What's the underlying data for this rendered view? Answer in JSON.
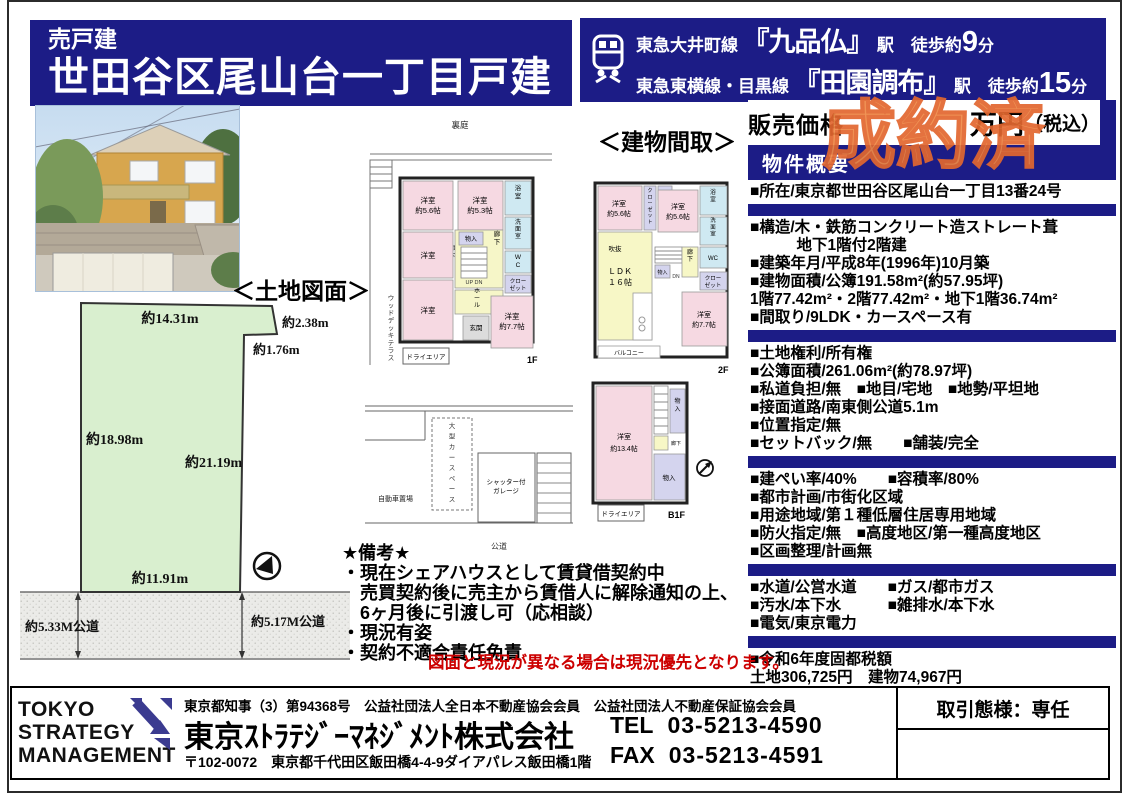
{
  "colors": {
    "navy": "#1c1c86",
    "stamp_orange": "#ef8a47",
    "caption_red": "#cc0000",
    "land_green": "#d9efcf"
  },
  "header": {
    "sale_type": "売戸建",
    "title": "世田谷区尾山台一丁目戸建"
  },
  "access": {
    "lines": [
      {
        "line": "東急大井町線",
        "station": "『九品仏』",
        "mid": "駅　徒歩約",
        "min": "9",
        "unit": "分"
      },
      {
        "line": "東急東横線・目黒線",
        "station": "『田園調布』",
        "mid": "駅　徒歩約",
        "min": "15",
        "unit": "分"
      }
    ]
  },
  "price": {
    "label": "販売価格",
    "stamp": "成約済",
    "unit": "万円",
    "tax": "（税込）"
  },
  "overview": {
    "header": "物件概要",
    "sections": [
      [
        "■所在/東京都世田谷区尾山台一丁目13番24号"
      ],
      [
        "■構造/木・鉄筋コンクリート造ストレート葺",
        "　　　地下1階付2階建",
        "■建築年月/平成8年(1996年)10月築",
        "■建物面積/公簿191.58m²(約57.95坪)",
        " 1階77.42m²・2階77.42m²・地下1階36.74m²",
        "■間取り/9LDK・カースペース有"
      ],
      [
        "■土地権利/所有権",
        "■公簿面積/261.06m²(約78.97坪)",
        "■私道負担/無　■地目/宅地　■地勢/平坦地",
        "■接面道路/南東側公道5.1m",
        "■位置指定/無",
        "■セットバック/無　　■舗装/完全"
      ],
      [
        "■建ぺい率/40%　　■容積率/80%",
        "■都市計画/市街化区域",
        "■用途地域/第１種低層住居専用地域",
        "■防火指定/無　■高度地区/第一種高度地区",
        "■区画整理/計画無"
      ],
      [
        "■水道/公営水道　　■ガス/都市ガス",
        "■汚水/本下水　　　■雑排水/本下水",
        "■電気/東京電力"
      ],
      [
        "■令和6年度固都税額",
        "土地306,725円　建物74,967円"
      ]
    ]
  },
  "land": {
    "title": "＜土地図面＞",
    "m_top": "約14.31m",
    "m_tr": "約2.38m",
    "m_r1": "約1.76m",
    "m_left": "約18.98m",
    "m_right": "約21.19m",
    "m_bottom": "約11.91m",
    "road_left": "約5.33M公道",
    "road_right": "約5.17M公道"
  },
  "plans": {
    "title": "＜建物間取＞",
    "f1": {
      "label": "1F",
      "yard": "裏庭",
      "deck": "ウッドデッキテラス",
      "r56": "洋室",
      "r56s": "約5.6帖",
      "r53": "洋室",
      "r53s": "約5.3帖",
      "bath": "浴室",
      "wash": "洗面室",
      "wc": "WC",
      "mono1": "物入",
      "hall_l": "廊下",
      "hall_r": "廊下",
      "clo_a": "クロー",
      "clo_b": "ゼット",
      "updn": "UP DN",
      "r3": "洋室",
      "r4": "洋室",
      "hall2": "ホール",
      "genkan": "玄関",
      "r77": "洋室",
      "r77s": "約7.7帖",
      "dry": "ドライエリア",
      "carspace": "大型カースペース",
      "garage1": "シャッター付",
      "garage2": "ガレージ",
      "parking": "自動車置場",
      "road": "公道"
    },
    "f2": {
      "label": "2F",
      "r1": "洋室",
      "r1s": "約5.6帖",
      "clo1": "クローゼット",
      "r2": "洋室",
      "r2s": "約5.6帖",
      "bath": "浴室",
      "wash": "洗面室",
      "wc": "WC",
      "clo2a": "クロー",
      "clo2b": "ゼット",
      "ldk": "ＬＤＫ",
      "ldks": "１６帖",
      "void": "吹抜",
      "mono": "物入",
      "dn": "DN",
      "hall": "廊下",
      "r3": "洋室",
      "r3s": "約7.7帖",
      "balcony": "バルコニー"
    },
    "b1": {
      "label": "B1F",
      "room": "洋室",
      "rooms": "約13.4帖",
      "mono1": "物入",
      "mono2": "物入",
      "up": "UP",
      "hall": "廊下",
      "dry": "ドライエリア"
    }
  },
  "remarks": {
    "lines": [
      "★備考★",
      "・現在シェアハウスとして賃貸借契約中",
      "　売買契約後に売主から賃借人に解除通知の上、",
      "　6ヶ月後に引渡し可（応相談）",
      "・現況有姿",
      "・契約不適合責任免責"
    ],
    "caption": "図面と現況が異なる場合は現況優先となります。"
  },
  "footer": {
    "logo": [
      "TOKYO",
      "STRATEGY",
      "MANAGEMENT"
    ],
    "license": "東京都知事（3）第94368号　公益社団法人全日本不動産協会会員　公益社団法人不動産保証協会会員",
    "company": "東京ｽﾄﾗﾃｼﾞｰﾏﾈｼﾞﾒﾝﾄ株式会社",
    "address": "〒102-0072　東京都千代田区飯田橋4-4-9ダイアパレス飯田橋1階",
    "tel_label": "TEL",
    "tel": "03-5213-4590",
    "fax_label": "FAX",
    "fax": "03-5213-4591",
    "deal": "取引態様：専任"
  }
}
